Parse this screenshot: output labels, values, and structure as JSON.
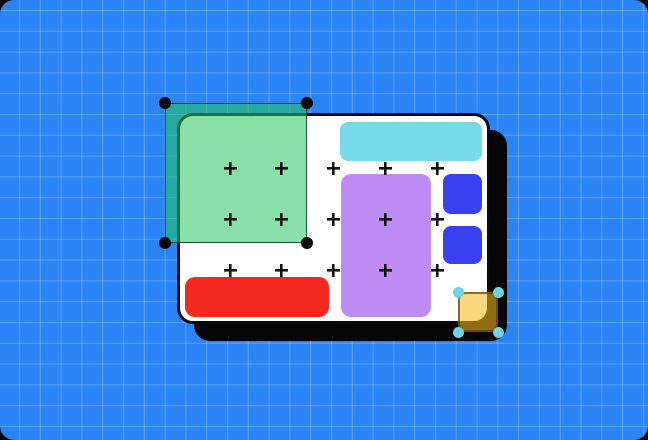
{
  "scene": {
    "background": {
      "name": "blueprint-grid-background",
      "color": "#2a84f6",
      "grid_line_color": "rgba(255,255,255,0.25)",
      "grid_size": 20.8,
      "grid_offset_x": 19,
      "grid_offset_y": 10,
      "corner_radius": 14,
      "outer_color": "#000000"
    },
    "canvas_card": {
      "name": "design-frame-card",
      "x": 177,
      "y": 113,
      "w": 313,
      "h": 211,
      "fill": "#ffffff",
      "stroke": "#0a0a0a",
      "stroke_width": 3,
      "radius": 16,
      "shadow_offset_x": 17,
      "shadow_offset_y": 17,
      "shadow_color": "#050505"
    },
    "blocks": [
      {
        "name": "cyan-bar",
        "x": 340,
        "y": 122,
        "w": 142,
        "h": 39,
        "r": 8,
        "fill": "#78d9ea"
      },
      {
        "name": "purple-panel",
        "x": 341,
        "y": 174,
        "w": 90,
        "h": 143,
        "r": 10,
        "fill": "#bd8bf2"
      },
      {
        "name": "blue-square-1",
        "x": 443,
        "y": 174,
        "w": 39,
        "h": 40,
        "r": 8,
        "fill": "#3a41f0"
      },
      {
        "name": "blue-square-2",
        "x": 443,
        "y": 226,
        "w": 39,
        "h": 38,
        "r": 8,
        "fill": "#3a41f0"
      },
      {
        "name": "red-bar",
        "x": 185,
        "y": 277,
        "w": 144,
        "h": 40,
        "r": 10,
        "fill": "#f3291f"
      }
    ],
    "plus_grid": {
      "name": "layout-grid-plus-marks",
      "xs": [
        230,
        281.75,
        333.5,
        385.25,
        437
      ],
      "ys": [
        168.5,
        219.5,
        270.5
      ],
      "size": 13,
      "thickness": 2.6,
      "color": "#111111"
    },
    "green_selection": {
      "name": "selected-green-rectangle",
      "x": 165,
      "y": 103,
      "w": 142,
      "h": 140,
      "fill": "rgba(40,198,94,0.55)",
      "stroke": "rgba(8,42,40,0.8)",
      "stroke_width": 1.5,
      "radius": 5,
      "handle_color": "#0a0a0a",
      "handle_size": 12.5
    },
    "yellow_selection": {
      "name": "selected-yellow-square",
      "x": 458,
      "y": 292,
      "w": 40,
      "h": 40,
      "fill": "rgba(248,184,30,0.57)",
      "stroke": "rgba(94,64,2,0.72)",
      "stroke_width": 2,
      "radius": 8,
      "handle_color": "#6fd3e6",
      "handle_size": 11
    }
  }
}
